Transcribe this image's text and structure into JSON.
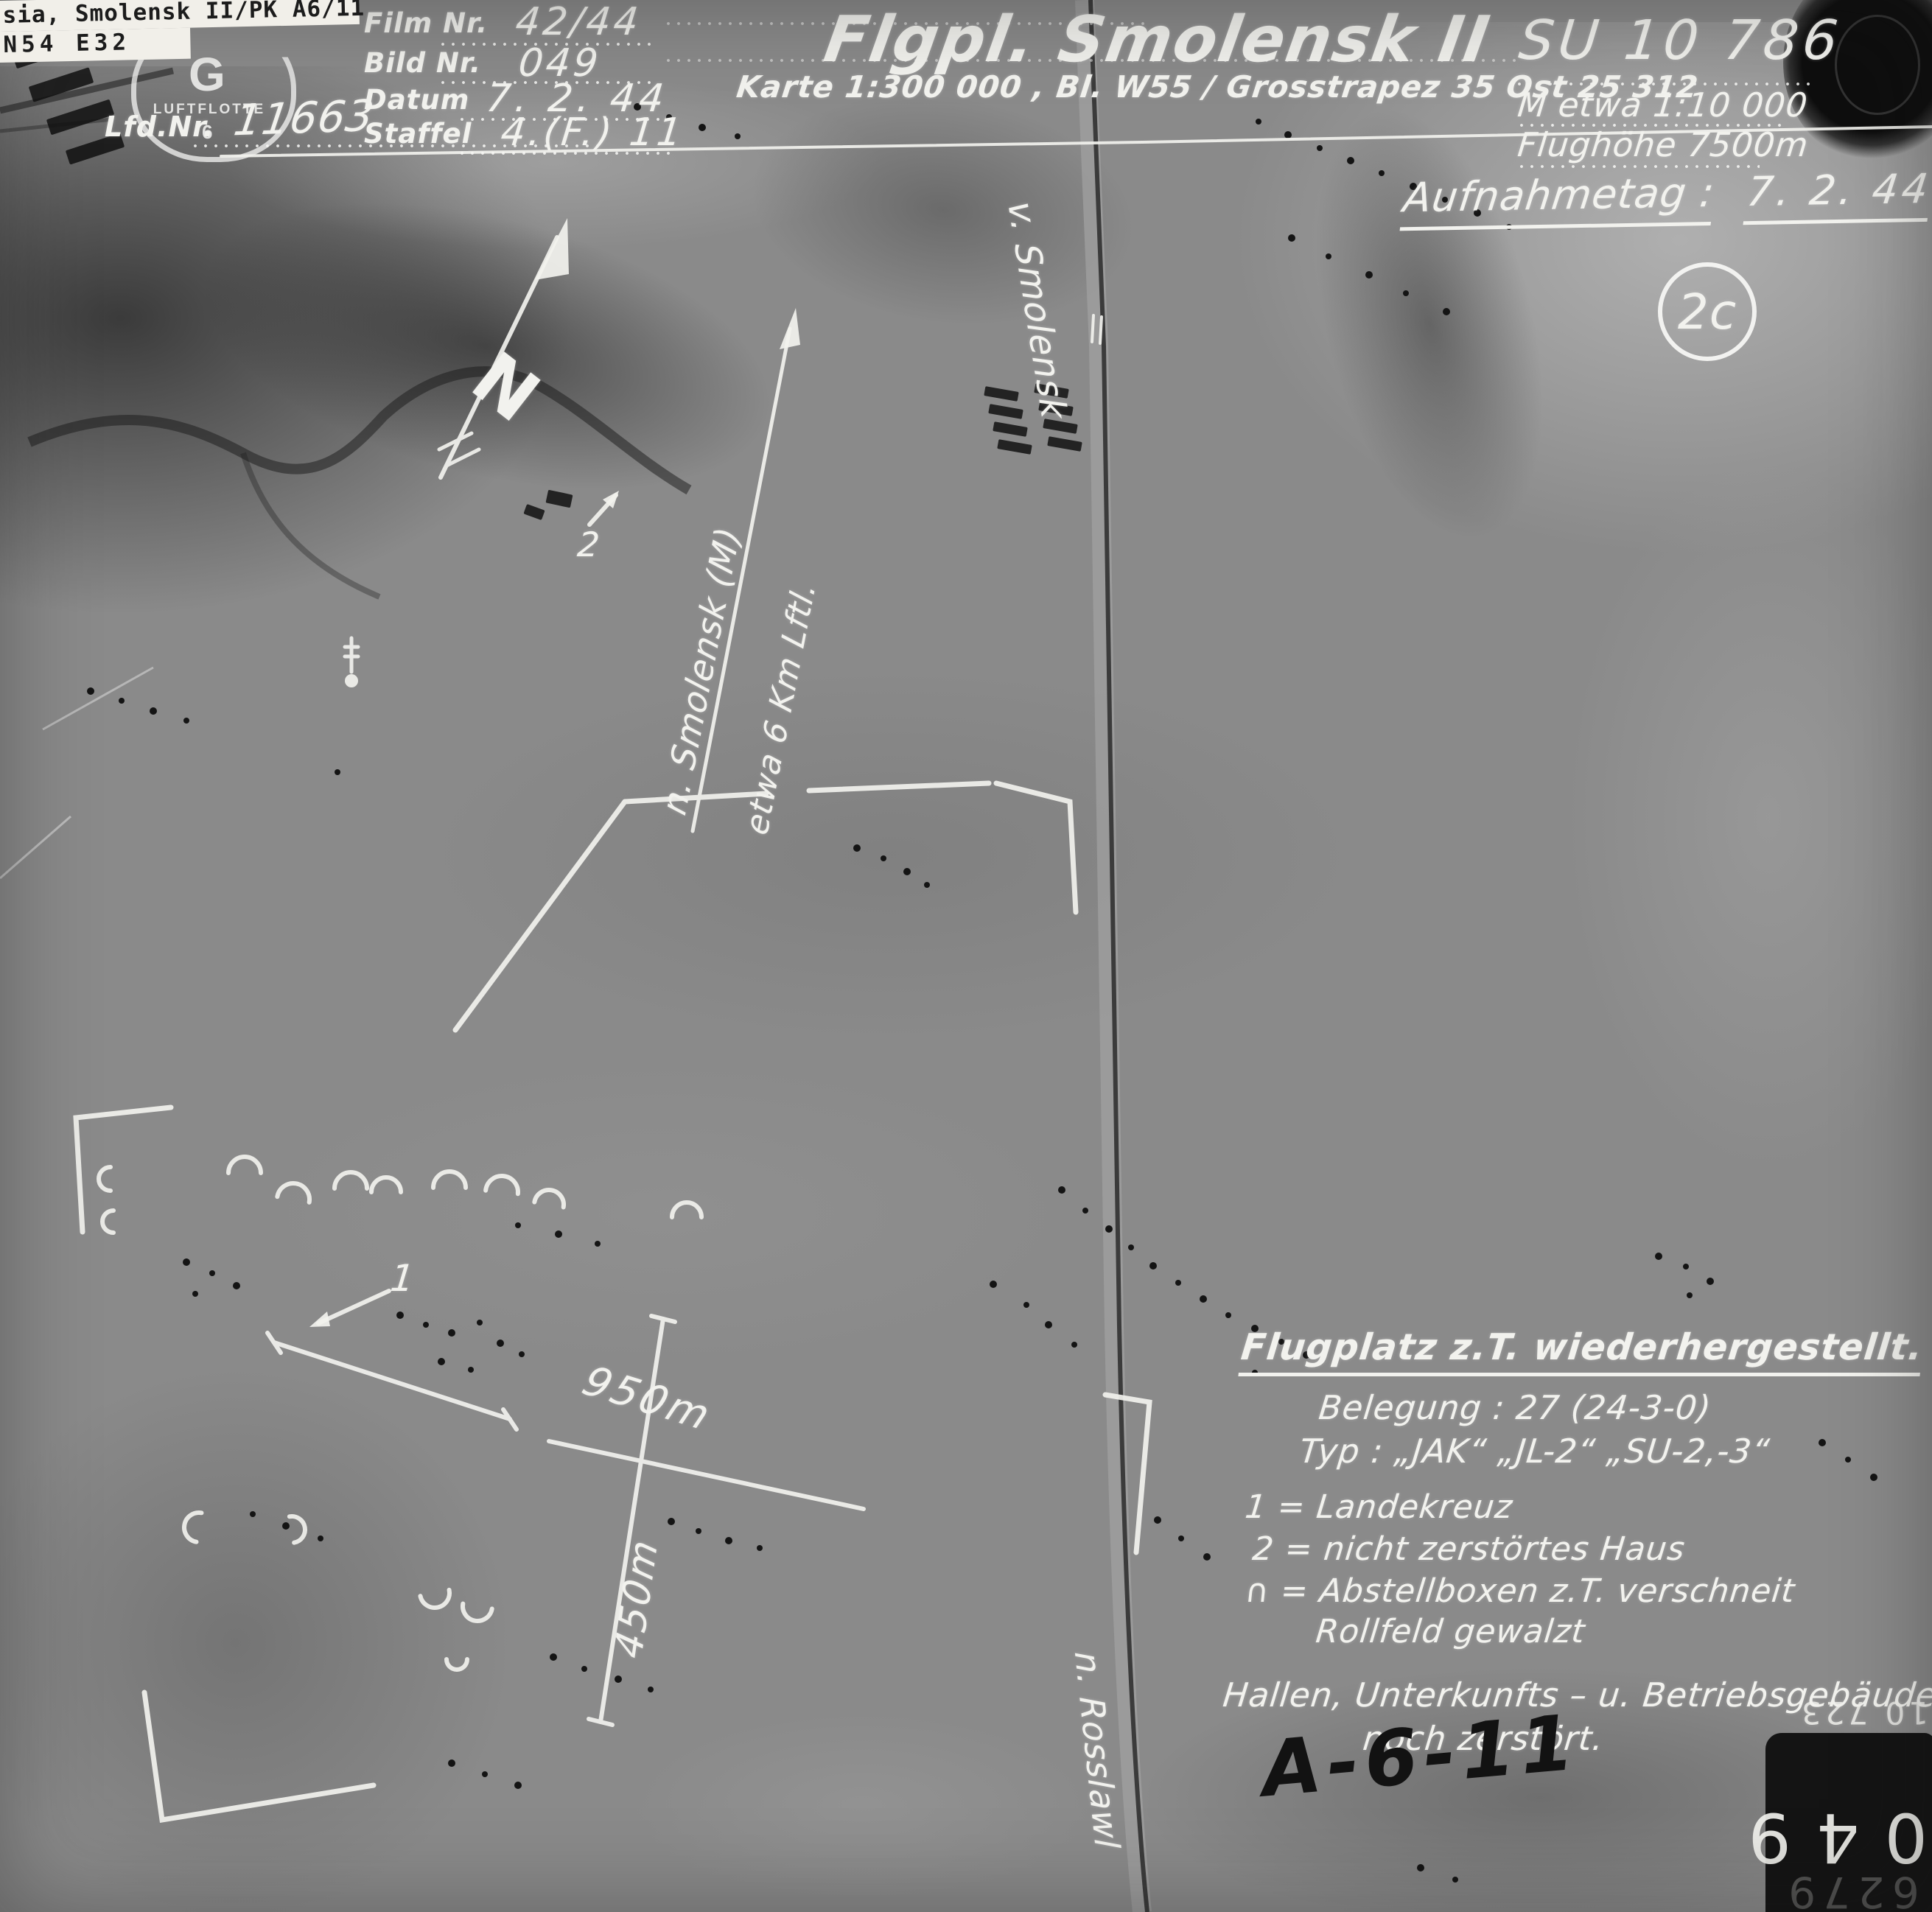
{
  "paper_label": {
    "line1": "sia, Smolensk II/PK A6/11",
    "line2": "N54  E32"
  },
  "stamp": {
    "letter": "G",
    "unit": "LUFTFLOTTE",
    "number": "6"
  },
  "header": {
    "lfd_nr_label": "Lfd.Nr.",
    "lfd_nr_value": "11663",
    "film_nr_label": "Film Nr.",
    "film_nr_value": "42/44",
    "bild_nr_label": "Bild Nr.",
    "bild_nr_value": "049",
    "datum_label": "Datum",
    "datum_value": "7. 2. 44",
    "staffel_label": "Staffel",
    "staffel_value": "4.(F.) 11",
    "title": "Flgpl. Smolensk II",
    "subtitle": "Karte 1:300 000 , Bl. W55 / Grosstrapez 35  Ost 25 312",
    "photo_ref": "SU 10 786",
    "scale_note": "M etwa 1:10 000",
    "flight_altitude": "Flughöhe 7500m"
  },
  "annotations": {
    "aufnahmetag_label": "Aufnahmetag :",
    "aufnahmetag_value": "7. 2. 44",
    "sortie_mark": "2c",
    "road_to_north": "v. Smolensk",
    "direction_line1": "n. Smolensk (M)",
    "direction_line2": "etwa 6 Km Lftl.",
    "road_to_south": "n. Rosslawl",
    "runway_length": "950m",
    "runway_width": "450m",
    "marker_1": "1",
    "marker_2": "2",
    "handwritten_ref": "A-6-11"
  },
  "notes": {
    "title": "Flugplatz z.T. wiederhergestellt.",
    "belegung": "Belegung :  27 (24-3-0)",
    "typ": "Typ :  „JAK“ „JL-2“ „SU-2,-3“",
    "legend_1": "1 =  Landekreuz",
    "legend_2": "2 =  nicht zerstörtes Haus",
    "legend_boxes": "∩ =  Abstellboxen z.T. verschneit",
    "legend_boxes_cont": "Rollfeld gewalzt",
    "footer_1": "Hallen, Unterkunfts – u. Betriebsgebäude",
    "footer_2": "noch zerstört."
  },
  "corner_marks": {
    "plate_number": "10 723",
    "box_digits_large": "049",
    "box_digits_faint": "6279"
  },
  "colors": {
    "annotation_white": "#f2f2ee",
    "handwriting_black": "#151515",
    "photo_mid_gray": "#8a8a8a"
  }
}
